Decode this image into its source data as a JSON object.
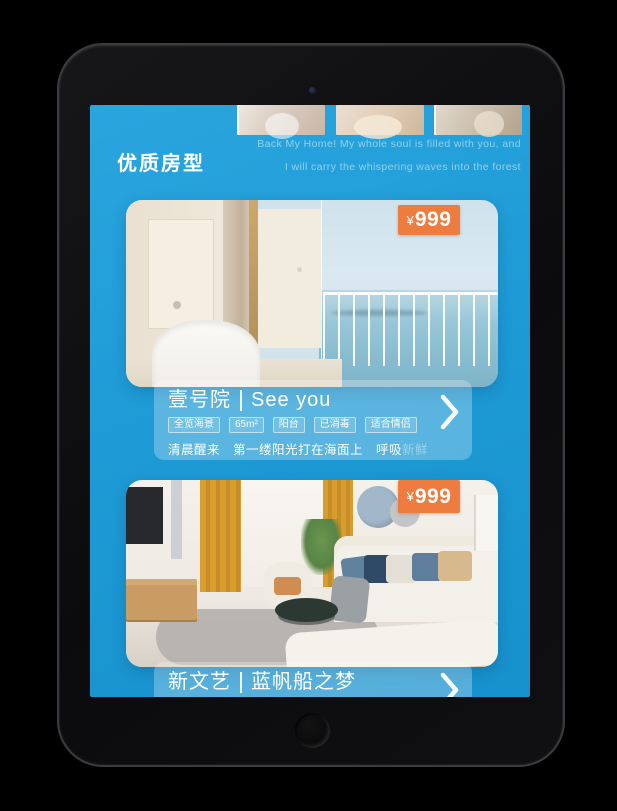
{
  "colors": {
    "screen_blue": "#1e9bd6",
    "badge_orange": "#ee7c3e"
  },
  "hero": {
    "caption_line1": "Back My Home! My whole soul is filled with you, and",
    "caption_line2": "I will carry the whispering waves into the forest",
    "section_title": "优质房型"
  },
  "cards": [
    {
      "currency": "¥",
      "amount": "999",
      "title_cn": "壹号院",
      "title_en": "See you",
      "tags": [
        "全览海景",
        "65m²",
        "阳台",
        "已消毒",
        "适合情侣"
      ],
      "desc_main": "清晨醒来　第一缕阳光打在海面上　呼吸",
      "desc_faded": "新鲜"
    },
    {
      "currency": "¥",
      "amount": "999",
      "title_cn": "新文艺",
      "title_en": "蓝帆船之梦"
    }
  ]
}
